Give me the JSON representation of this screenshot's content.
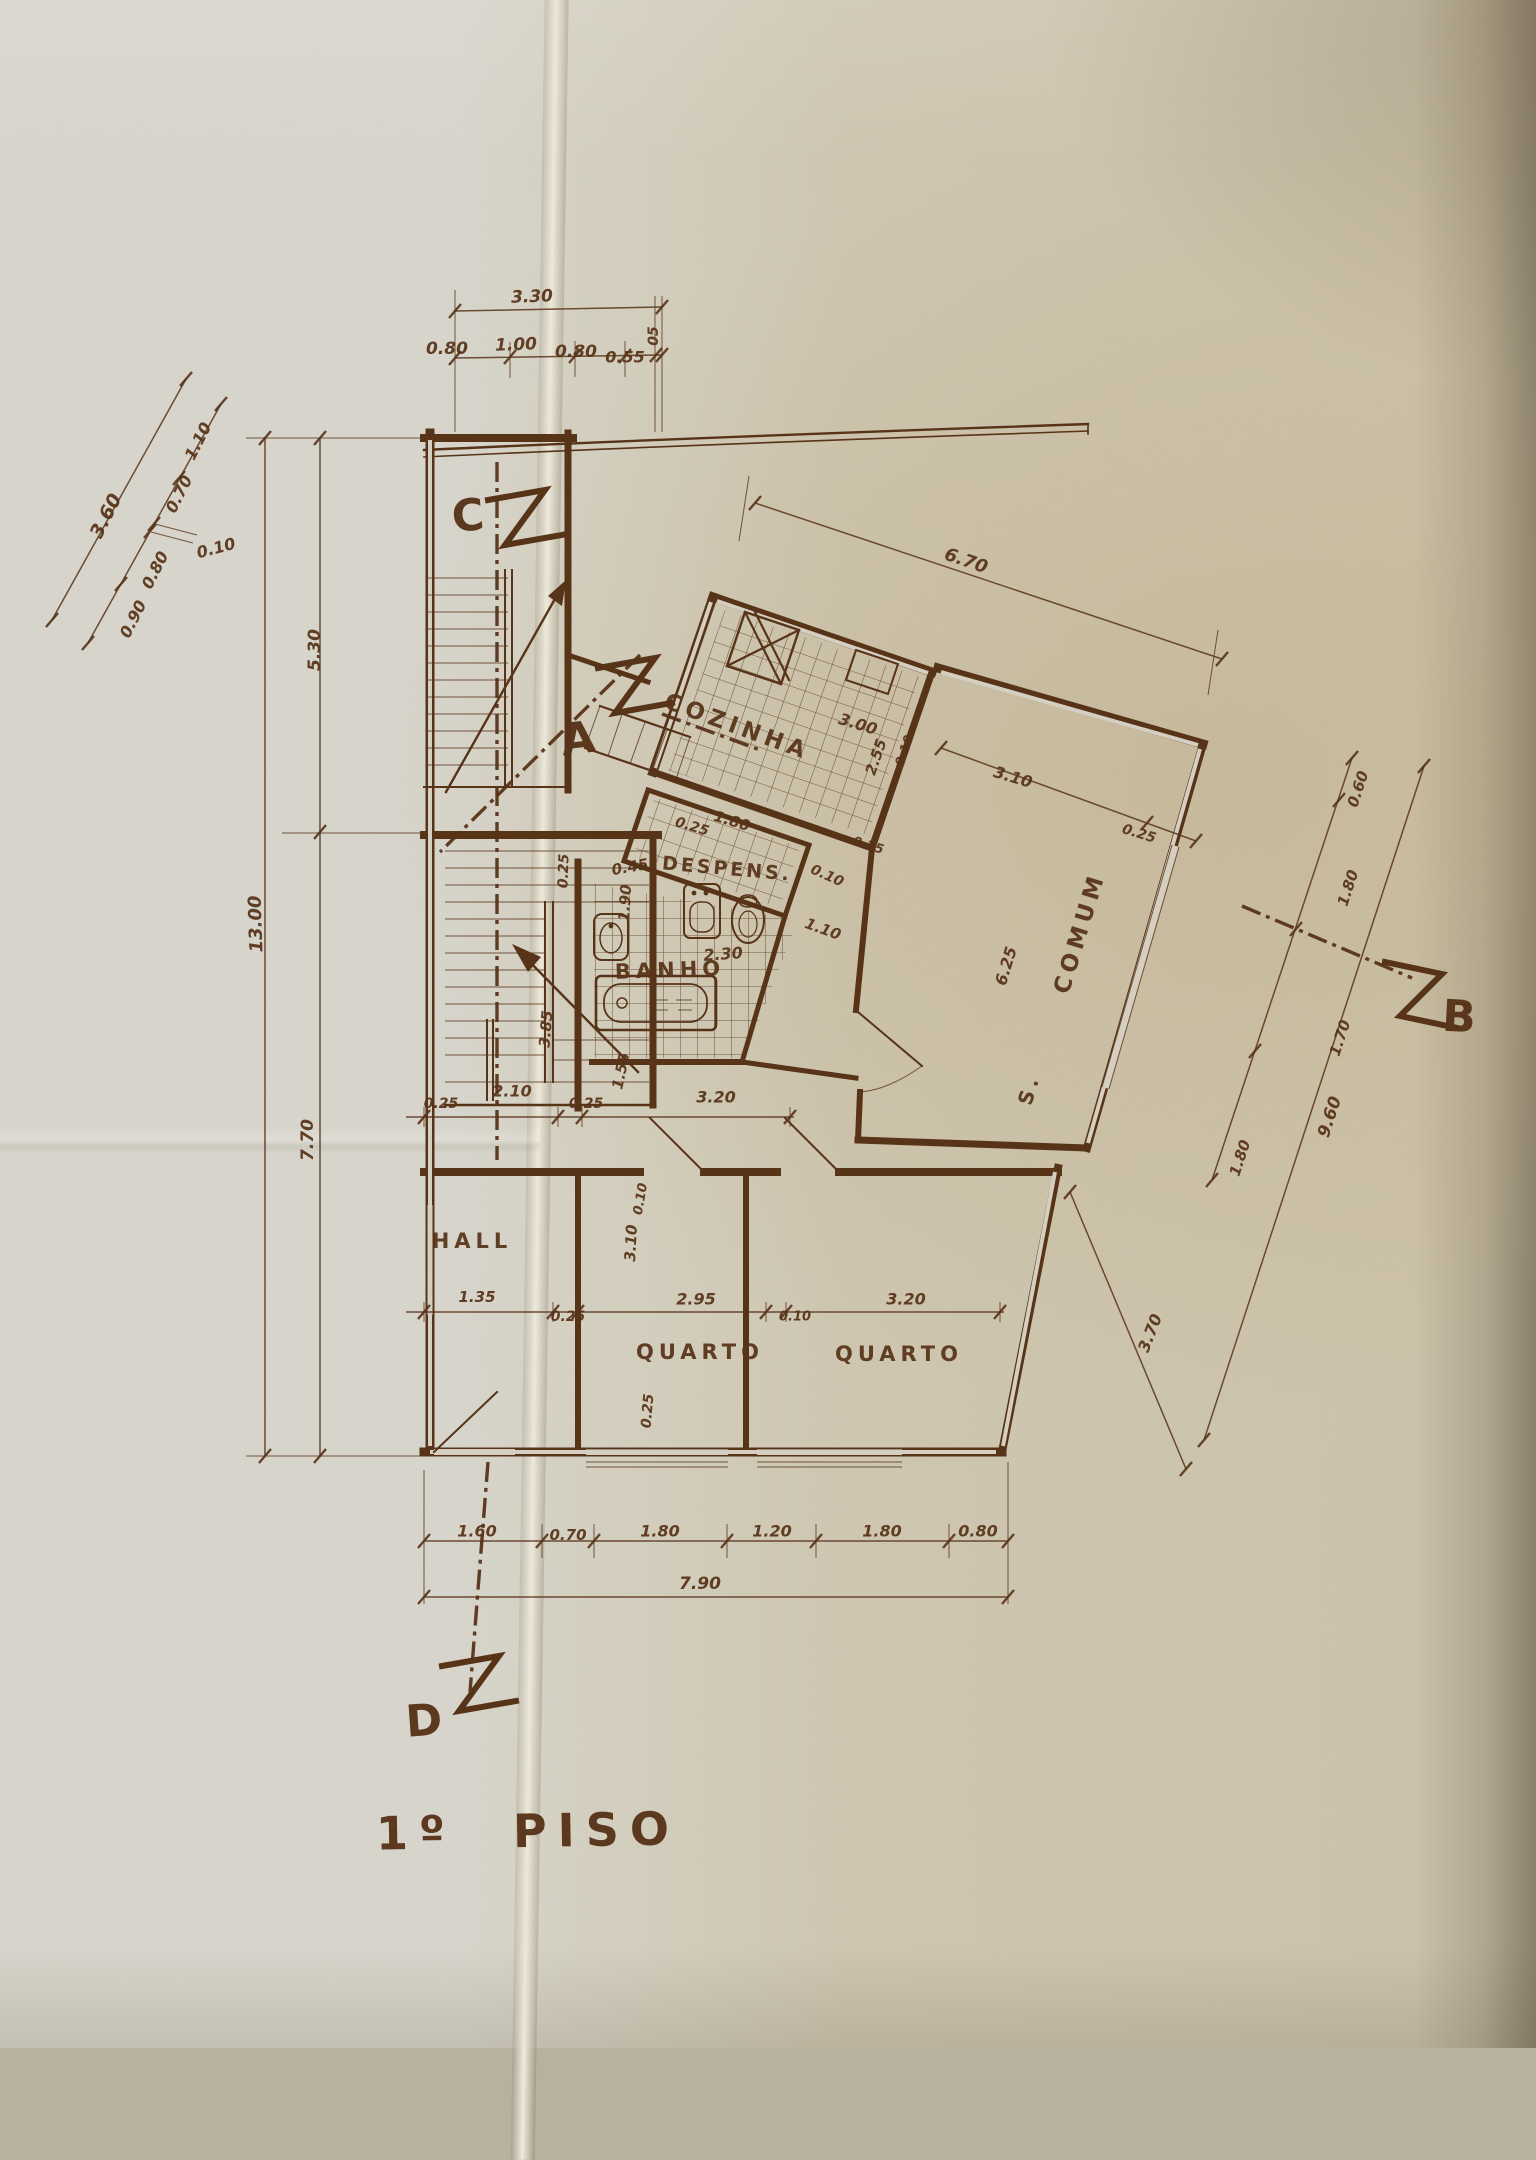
{
  "colors": {
    "ink": "#573318",
    "paper": "#d4cfc1"
  },
  "title": "1º PISO",
  "rooms": {
    "cozinha": "COZINHA",
    "despensa": "DESPENS.",
    "banho": "BANHO",
    "s": "S.",
    "comum": "COMUM",
    "hall": "HALL",
    "quarto1": "QUARTO",
    "quarto2": "QUARTO"
  },
  "markers": {
    "a": "A",
    "b": "B",
    "c": "C",
    "d": "D"
  },
  "dims": {
    "top": {
      "total": "3.30",
      "segs": [
        "0.80",
        "1.00",
        "0.80",
        "0.55",
        "05"
      ]
    },
    "left_diag": {
      "total": "3.60",
      "segs": [
        "0.90",
        "0.80",
        "0.10",
        "0.70",
        "1.10"
      ]
    },
    "left_vert": {
      "total": "13.00",
      "segs": [
        "5.30",
        "7.70"
      ]
    },
    "kitchen": {
      "top": "6.70",
      "width": "3.00",
      "depth": "2.55",
      "wall": "0.10",
      "below_a": "0.25",
      "below_b": "1.80"
    },
    "living": {
      "a": "3.10",
      "b": "0.25",
      "c": "0.25",
      "len": "6.25"
    },
    "bath": {
      "a0": "0.45",
      "a1": "1.90",
      "a2": "0.10",
      "a3": "1.10",
      "a4": "2.30",
      "a5": "0.25",
      "a6": "1.55",
      "a7": "3.85"
    },
    "right": {
      "segs": [
        "0.60",
        "1.80",
        "1.70",
        "1.80"
      ],
      "total": "9.60",
      "diag": "3.70"
    },
    "mid": [
      "0.25",
      "2.10",
      "0.25",
      "3.20"
    ],
    "band": {
      "hall_w": "1.35",
      "a": "0.25",
      "b1h": "3.10",
      "t1": "0.10",
      "b1w": "2.95",
      "t2": "0.10",
      "b2w": "3.20",
      "c": "0.25"
    },
    "bottom": {
      "segs": [
        "1.60",
        "0.70",
        "1.80",
        "1.20",
        "1.80",
        "0.80"
      ],
      "total": "7.90"
    }
  }
}
